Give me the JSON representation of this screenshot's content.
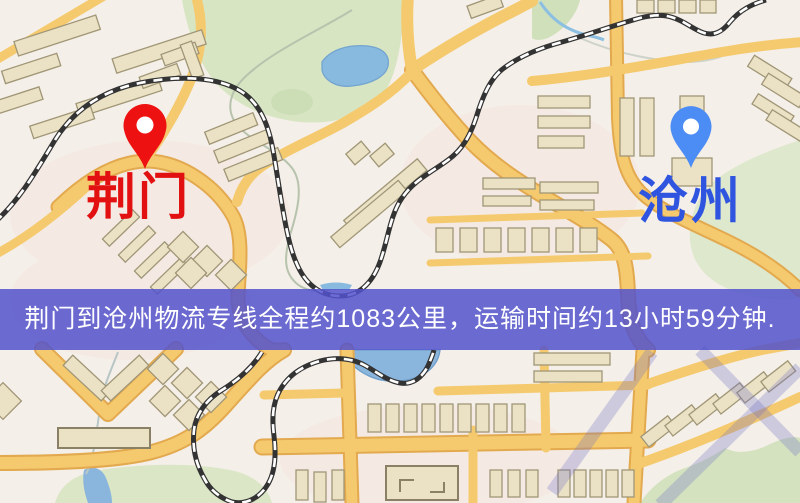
{
  "map": {
    "origin": {
      "label": "荆门",
      "pin_color": "#ee1111",
      "label_color": "#e21010"
    },
    "destination": {
      "label": "沧州",
      "pin_color": "#4c8cf5",
      "label_color": "#2f55e0"
    }
  },
  "banner": {
    "text": "荆门到沧州物流专线全程约1083公里，运输时间约13小时59分钟.",
    "distance_km": "1083",
    "duration": "13小时59分钟",
    "background_color": "#5252cc",
    "text_color": "#ffffff"
  },
  "palette": {
    "map_background": "#f4efe8",
    "road": "#f5ca6e",
    "road_border": "#e3a94f",
    "water": "#8ab5dd",
    "park": "#d7e5c3",
    "building": "#ebe2c6",
    "railway": "#333333"
  }
}
